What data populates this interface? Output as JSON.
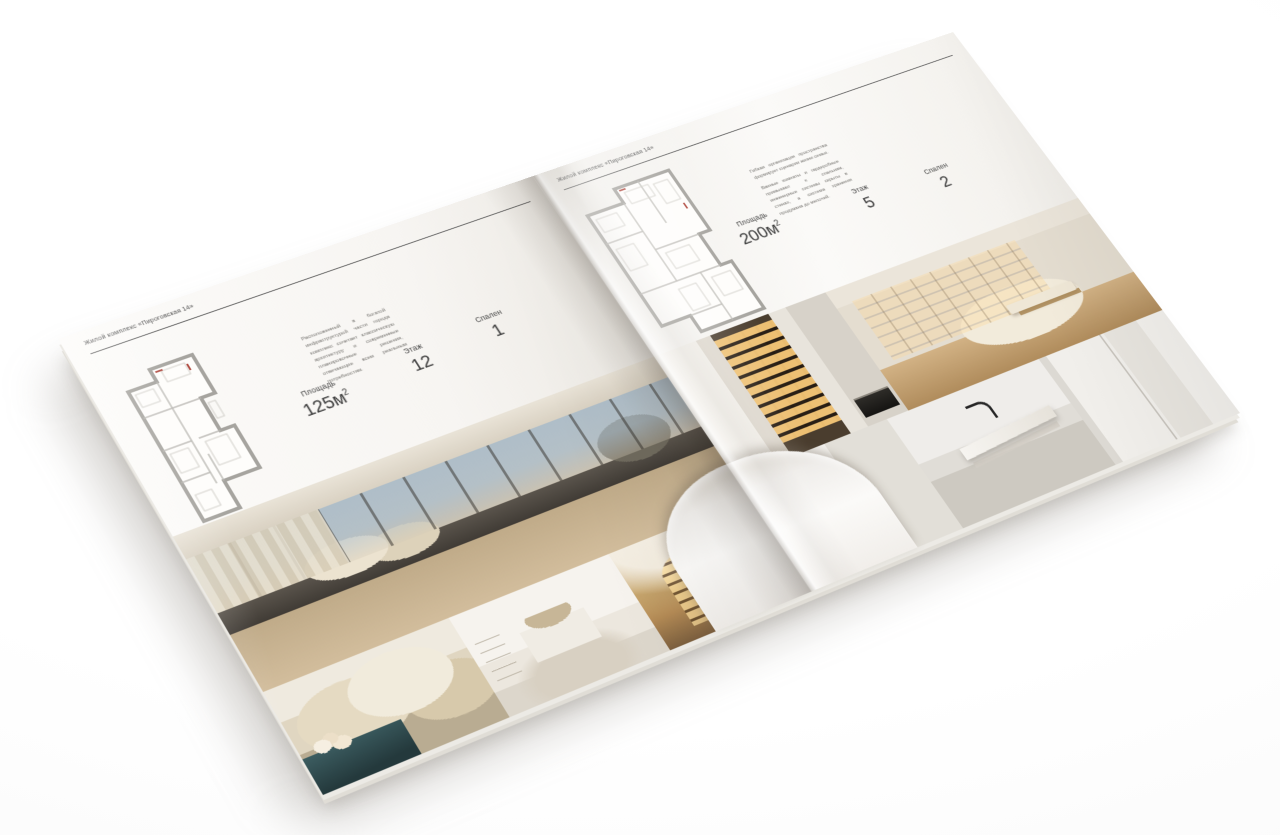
{
  "scene": {
    "background_color": "#ffffff",
    "paper_color": "#f7f5f2",
    "accent_text_color": "#3c3c3c"
  },
  "brochure": {
    "running_head": "Жилой комплекс «Пироговская 14»",
    "left_page": {
      "description": "Расположенный в богатой инфраструктурой части города комплекс сочетает классическую архитектуру и современные планировочные решения, отвечающие всем реальным потребностям.",
      "stats": {
        "area_label": "Площадь",
        "area_value": "125м",
        "area_sup": "2",
        "floor_label": "Этаж",
        "floor_value": "12",
        "bedrooms_label": "Спален",
        "bedrooms_value": "1"
      },
      "floor_plan": "plan-125",
      "photos": [
        "bedroom-panorama",
        "bedroom-pillows",
        "white-bedroom",
        "hallway-arch-shelves"
      ]
    },
    "right_page": {
      "description_1": "Гибкая организация пространства формирует сценарии жизни семьи.",
      "description_2": "Ванные комнаты и гардеробные примыкают к спальням, инженерные системы скрыты в стенах, а система хранения продумана до мелочей.",
      "stats": {
        "area_label": "Площадь",
        "area_value": "200м",
        "area_sup": "2",
        "floor_label": "Этаж",
        "floor_value": "5",
        "bedrooms_label": "Спален",
        "bedrooms_value": "2"
      },
      "floor_plan": "plan-200",
      "photos": [
        "wine-cabinet-hall",
        "living-room-shelves",
        "bathroom-towel",
        "bathroom-vanity",
        "bathroom-shower"
      ]
    }
  }
}
